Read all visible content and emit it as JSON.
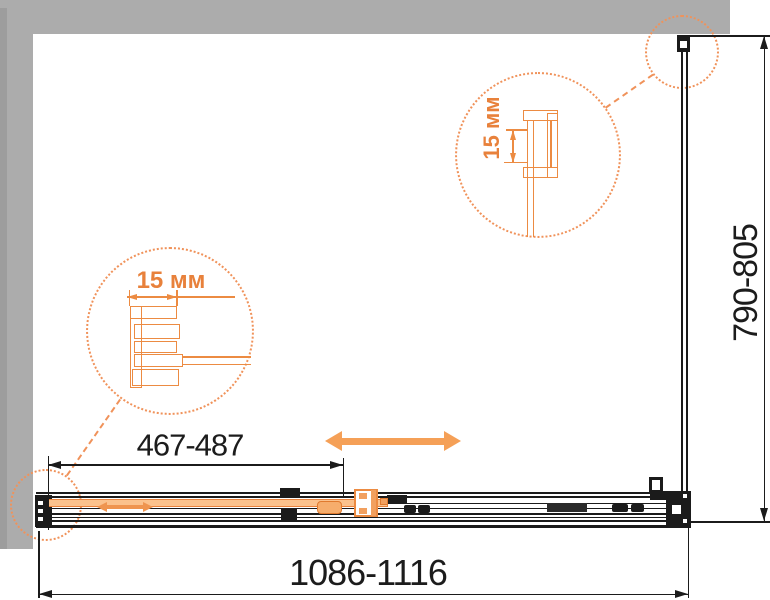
{
  "drawing": {
    "dim_total_width": "1086-1116",
    "dim_door_width": "467-487",
    "dim_depth": "790-805",
    "callout_left_size": "15 мм",
    "callout_top_size": "15 мм"
  },
  "colors": {
    "accent_orange": "#EC8B42",
    "door_fill_orange": "#FBC28D",
    "dotted_circle_orange": "#F0925A",
    "wall_gray": "#ACACAC",
    "line_black": "#1B1B1B"
  }
}
